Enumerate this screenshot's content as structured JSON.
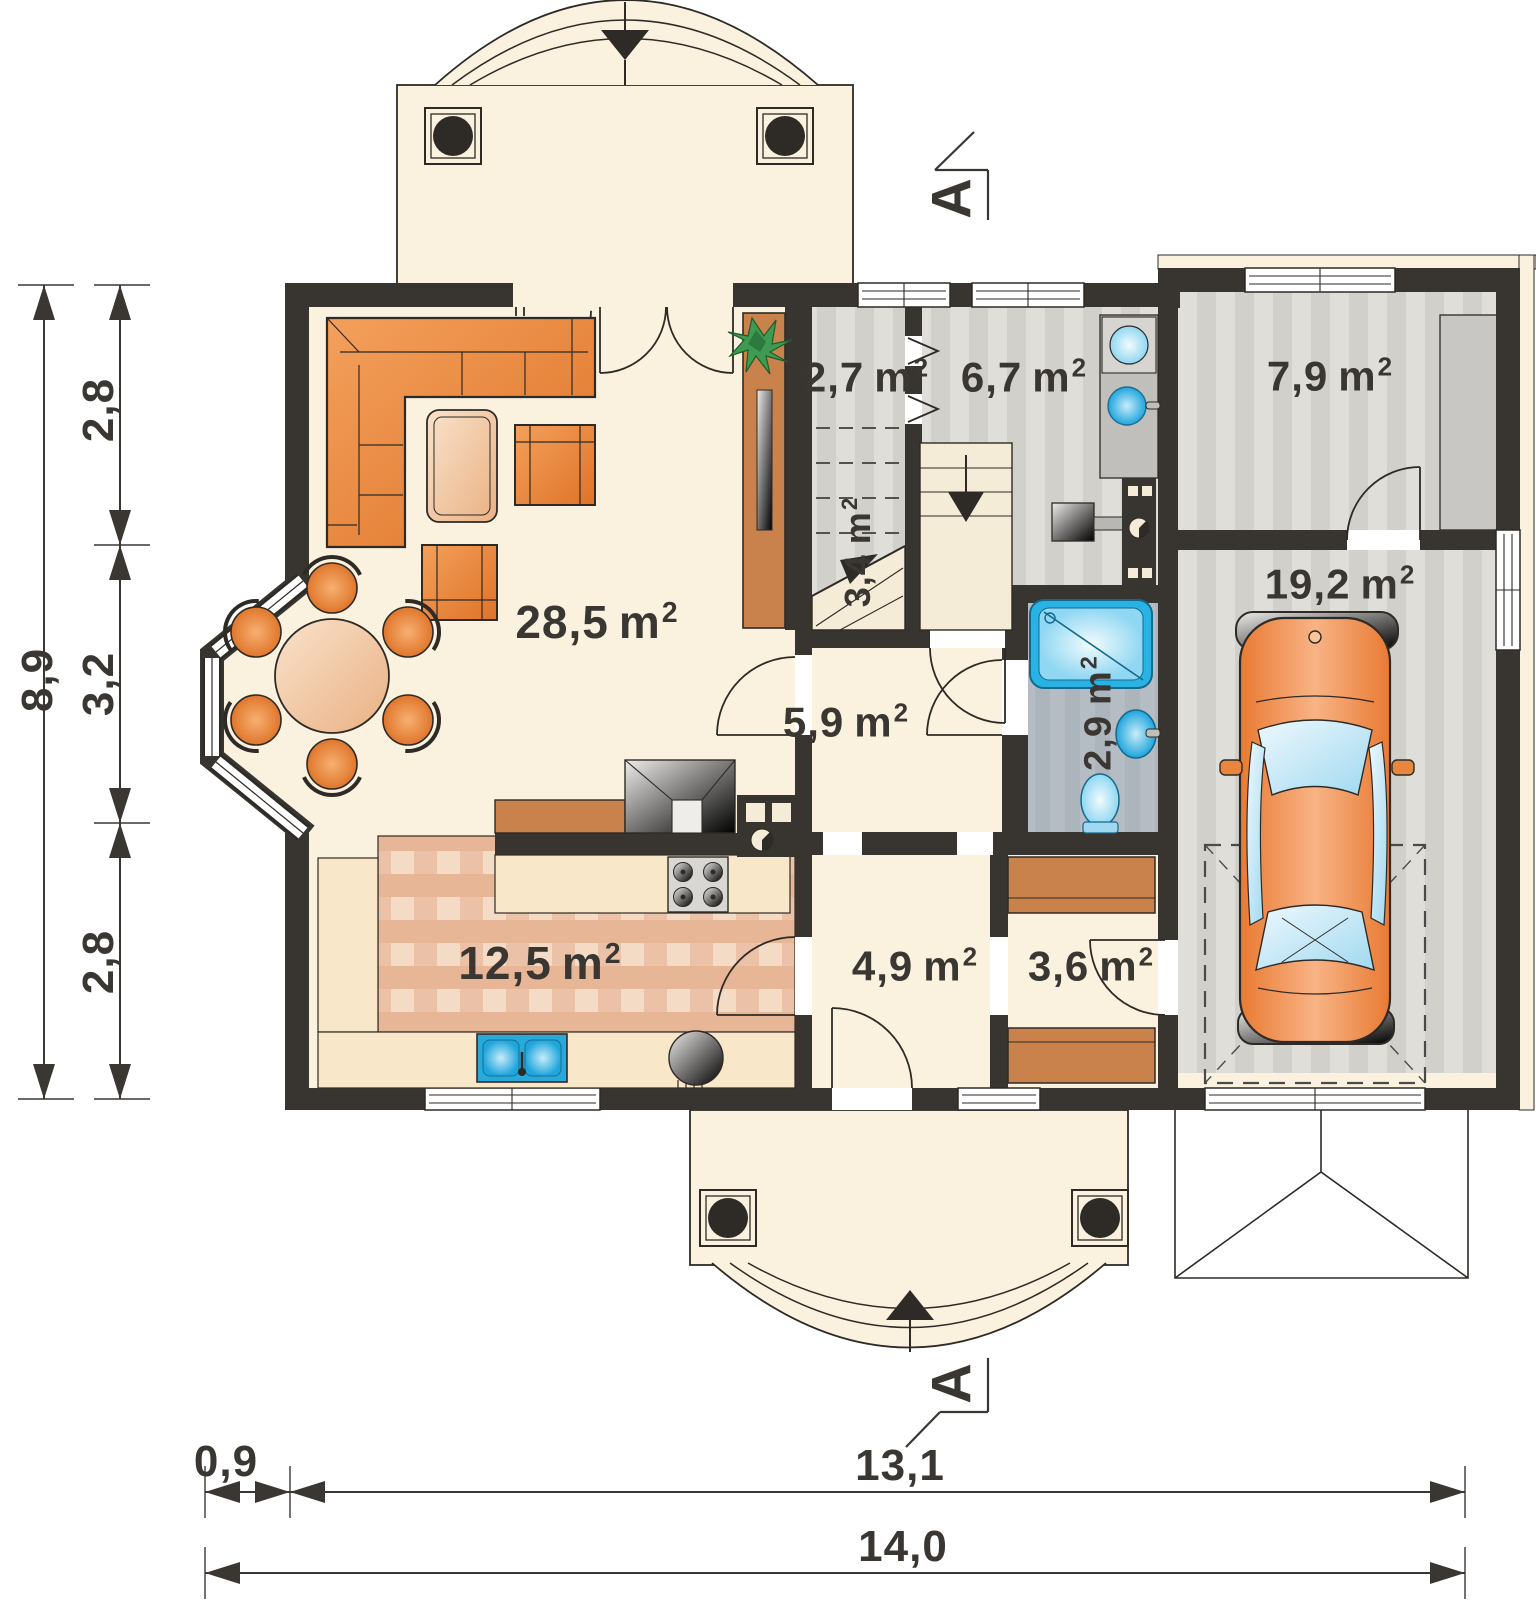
{
  "rooms": {
    "living": {
      "area": "28,5",
      "unit": "m",
      "sup": "2"
    },
    "kitchen": {
      "area": "12,5",
      "unit": "m",
      "sup": "2"
    },
    "hall": {
      "area": "5,9",
      "unit": "m",
      "sup": "2"
    },
    "hall_lower": {
      "area": "4,9",
      "unit": "m",
      "sup": "2"
    },
    "wardrobe": {
      "area": "3,6",
      "unit": "m",
      "sup": "2"
    },
    "stair_hall": {
      "area": "2,7",
      "unit": "m",
      "sup": "2"
    },
    "stairs": {
      "area": "3,4",
      "unit": "m",
      "sup": "2"
    },
    "utility": {
      "area": "6,7",
      "unit": "m",
      "sup": "2"
    },
    "storage": {
      "area": "7,9",
      "unit": "m",
      "sup": "2"
    },
    "bathroom": {
      "area": "2,9",
      "unit": "m",
      "sup": "2"
    },
    "garage": {
      "area": "19,2",
      "unit": "m",
      "sup": "2"
    }
  },
  "dimensions": {
    "left_total": "8,9",
    "left_seg_top": "2,8",
    "left_seg_mid": "3,2",
    "left_seg_bottom": "2,8",
    "bottom_offset": "0,9",
    "bottom_main": "13,1",
    "bottom_total": "14,0"
  },
  "section_markers": {
    "top": "A",
    "bottom": "A"
  },
  "colors": {
    "wall": "#38342f",
    "floor_cream": "#faf2df",
    "floor_stripe_light": "#e0ded9",
    "floor_stripe_dark": "#d2d0cb",
    "kitchen_tile": "#e7b697",
    "bath_floor": "#b5bcc3",
    "furniture_orange": "#e8863e",
    "cabinet_brown": "#c9824b",
    "fixture_blue": "#29b2e4",
    "line_dark": "#2e2a26"
  }
}
